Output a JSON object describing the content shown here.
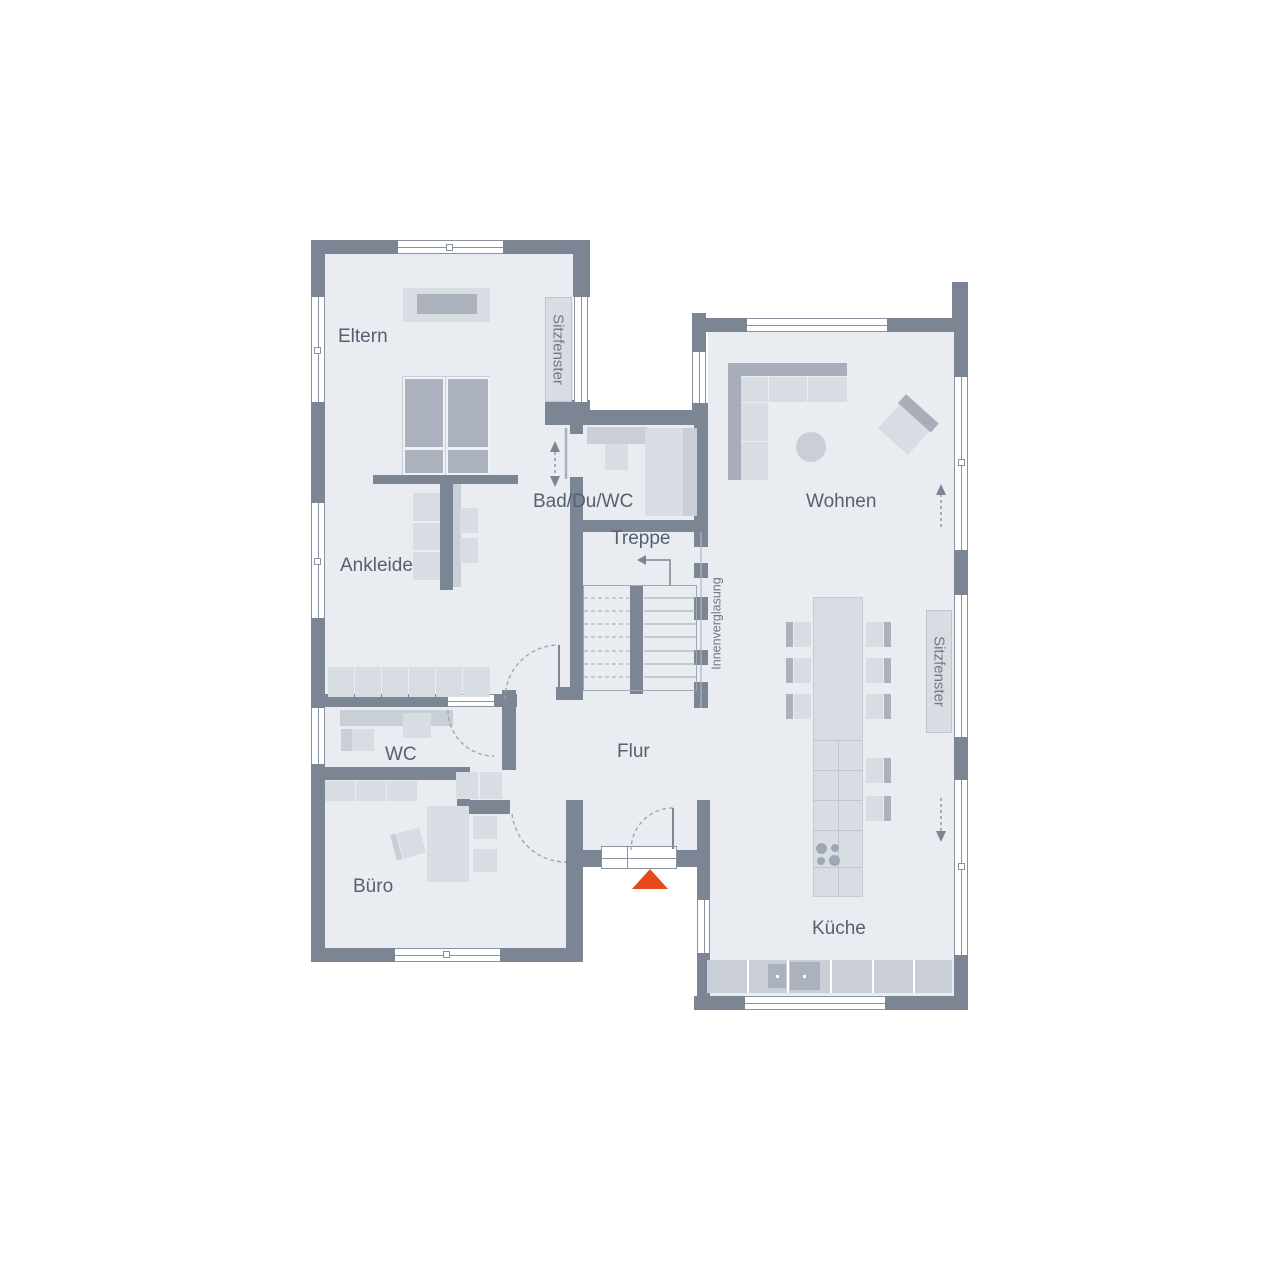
{
  "plan_title": "Grundriss Erdgeschoss",
  "rooms": {
    "eltern": {
      "label": "Eltern"
    },
    "ankleide": {
      "label": "Ankleide"
    },
    "bad": {
      "label": "Bad/Du/WC"
    },
    "treppe": {
      "label": "Treppe"
    },
    "wc": {
      "label": "WC"
    },
    "buero": {
      "label": "Büro"
    },
    "flur": {
      "label": "Flur"
    },
    "wohnen": {
      "label": "Wohnen"
    },
    "kueche": {
      "label": "Küche"
    }
  },
  "annotations": {
    "sitzfenster_left": "Sitzfenster",
    "sitzfenster_right": "Sitzfenster",
    "innenverglasung": "Innenverglasung"
  },
  "colors": {
    "wall": "#7b8594",
    "floor": "#e9ecf1",
    "furniture_light": "#d8dce3",
    "furniture_mid": "#c9ced7",
    "furniture_dark": "#abb2be",
    "sofa_back": "#a7aeba",
    "label_box": "#d9dde3",
    "window_frame": "#8a93a1",
    "line": "#9aa3af",
    "text": "#566070",
    "text_soft": "#6e7884",
    "accent": "#e8481c"
  }
}
